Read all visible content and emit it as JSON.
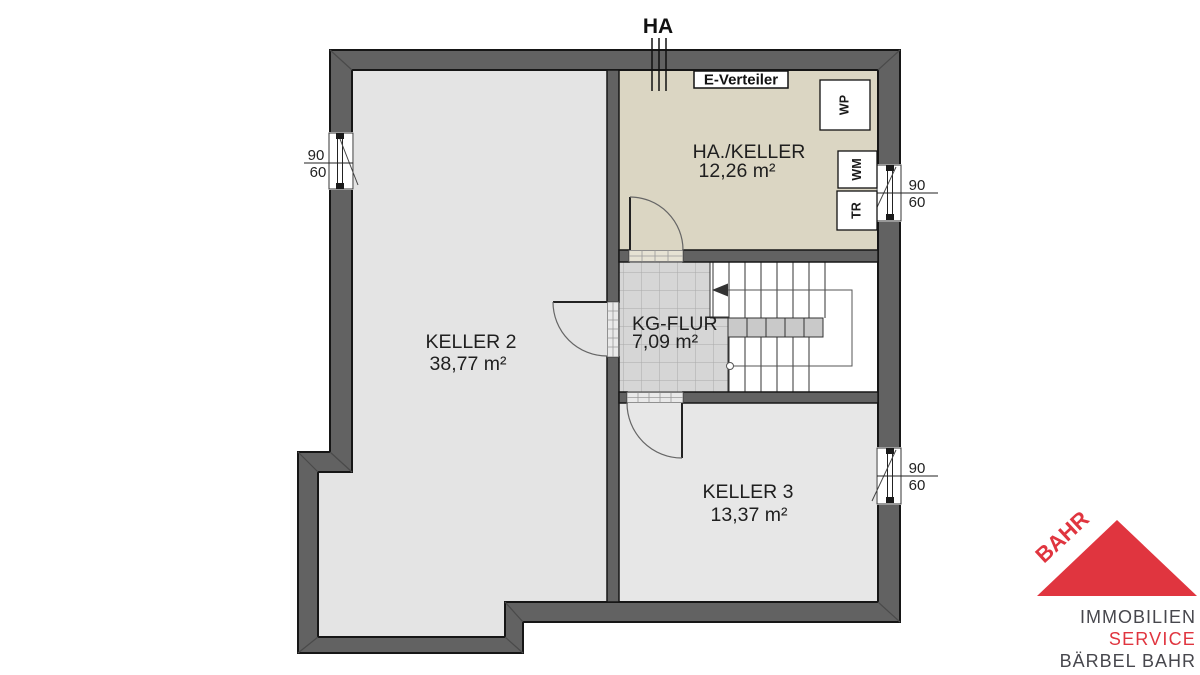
{
  "plan": {
    "connection_label": "HA",
    "distribution_box_label": "E-Verteiler",
    "rooms": {
      "keller2": {
        "name": "KELLER 2",
        "area": "38,77 m²"
      },
      "ha_keller": {
        "name": "HA./KELLER",
        "area": "12,26 m²"
      },
      "kg_flur": {
        "name": "KG-FLUR",
        "area": "7,09 m²"
      },
      "keller3": {
        "name": "KELLER 3",
        "area": "13,37 m²"
      }
    },
    "appliances": {
      "wp": "WP",
      "wm": "WM",
      "tr": "TR"
    },
    "windows": [
      {
        "w": "90",
        "h": "60"
      },
      {
        "w": "90",
        "h": "60"
      },
      {
        "w": "90",
        "h": "60"
      }
    ],
    "colors": {
      "wall": "#626262",
      "keller2_floor": "#e4e4e4",
      "ha_keller_floor": "#dbd6c3",
      "kg_flur_tiles": "#d6d6d6",
      "keller3_floor": "#e7e7e7",
      "stair_flight": "#c9c9c9"
    }
  },
  "logo": {
    "brand": "BAHR",
    "line1": "IMMOBILIEN",
    "line2": "SERVICE",
    "line3": "BÄRBEL BAHR",
    "colors": {
      "red": "#e0353f",
      "dark": "#47474d"
    }
  }
}
